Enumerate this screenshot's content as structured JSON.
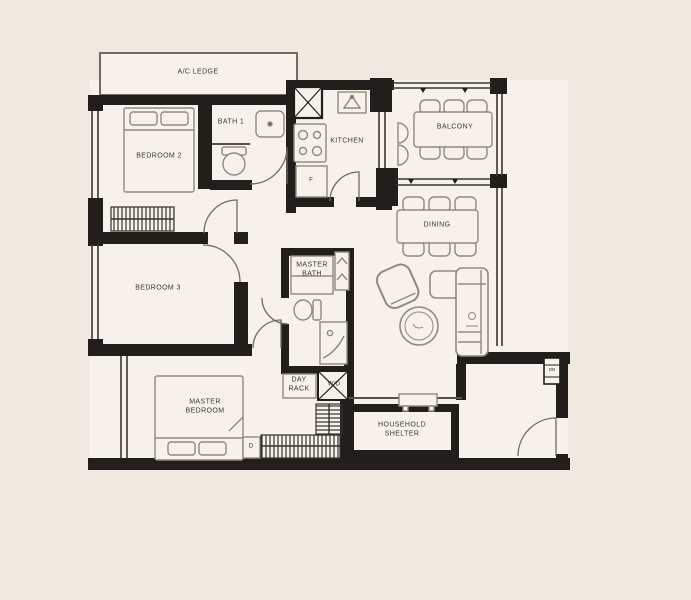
{
  "meta": {
    "type": "apartment-floorplan",
    "background_color": "#efe9e1",
    "room_fill_color": "#f6f2eb",
    "wall_color": "#211e1b",
    "furniture_line_color": "#8f8a81",
    "label_color": "#3a3631"
  },
  "floorplan": {
    "labels": [
      {
        "id": "ac-ledge",
        "text": "A/C LEDGE"
      },
      {
        "id": "bath-1",
        "text": "BATH 1"
      },
      {
        "id": "bedroom-2",
        "text": "BEDROOM 2"
      },
      {
        "id": "kitchen",
        "text": "KITCHEN"
      },
      {
        "id": "fridge",
        "text": "F"
      },
      {
        "id": "balcony",
        "text": "BALCONY"
      },
      {
        "id": "dining",
        "text": "DINING"
      },
      {
        "id": "bedroom-3",
        "text": "BEDROOM 3"
      },
      {
        "id": "master-bath",
        "text": "MASTER BATH"
      },
      {
        "id": "day-rack",
        "text": "DAY RACK"
      },
      {
        "id": "washer-dryer",
        "text": "W/D"
      },
      {
        "id": "master-bedroom",
        "text": "MASTER BEDROOM"
      },
      {
        "id": "dresser",
        "text": "D"
      },
      {
        "id": "household-shelter",
        "text": "HOUSEHOLD SHELTER"
      },
      {
        "id": "distribution-board",
        "text": "DB"
      }
    ],
    "furniture": [
      "queen-bed-bedroom-2",
      "wardrobe-bedroom-2",
      "queen-bed-bedroom-3",
      "wardrobe-bedroom-3",
      "king-bed-master",
      "l-wardrobe-master",
      "dresser",
      "vanity-master-bath",
      "shower-master-bath",
      "toilet-master-bath",
      "linen-shelf",
      "toilet-bath-1",
      "basin-bath-1",
      "sink-kitchen",
      "hob-kitchen",
      "fridge",
      "shaft",
      "dining-table-6-chairs",
      "balcony-table-6-chairs",
      "armchair",
      "coffee-table",
      "l-sofa",
      "console-table",
      "day-rack",
      "washer-dryer"
    ]
  }
}
